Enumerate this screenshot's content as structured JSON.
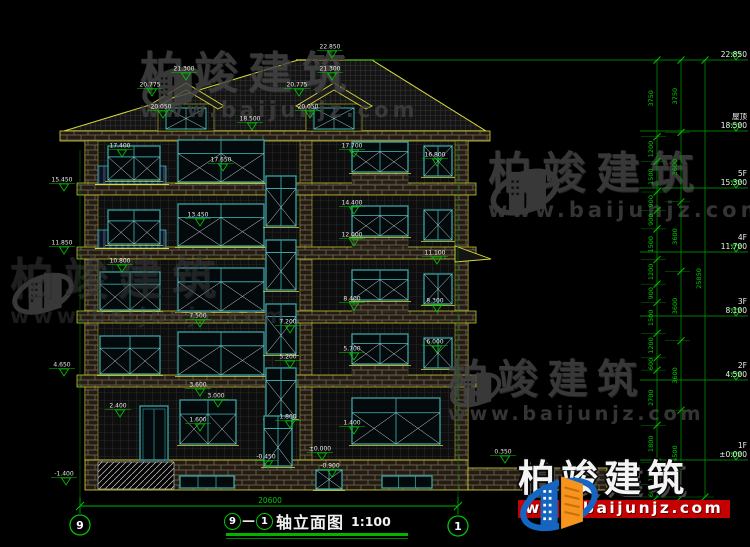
{
  "page": {
    "bg": "#000000"
  },
  "title_block": {
    "axis_start": "9",
    "dash": "—",
    "axis_end": "1",
    "name": "轴立面图",
    "scale": "1:100"
  },
  "bottom": {
    "total_dim": "20600",
    "axis_left": "9",
    "axis_right": "1"
  },
  "levels": [
    {
      "label": "",
      "value": "22.850",
      "y": 60
    },
    {
      "label": "屋顶",
      "value": "18.500",
      "y": 131
    },
    {
      "label": "5F",
      "value": "15.300",
      "y": 188
    },
    {
      "label": "4F",
      "value": "11.700",
      "y": 252
    },
    {
      "label": "3F",
      "value": "8.100",
      "y": 316
    },
    {
      "label": "2F",
      "value": "4.500",
      "y": 380
    },
    {
      "label": "1F",
      "value": "±0.000",
      "y": 460
    }
  ],
  "dim_chains": {
    "inner": [
      "3750",
      "1200",
      "1500",
      "900",
      "900",
      "1500",
      "1200",
      "900",
      "1500",
      "1200",
      "600",
      "2700",
      "1800",
      "1100",
      "600"
    ],
    "middle": [
      "3750",
      "3600",
      "3600",
      "3600",
      "3600",
      "4500"
    ],
    "total": [
      "25850"
    ]
  },
  "elevation_markers": [
    {
      "v": "22.850",
      "x": 332,
      "y": 58
    },
    {
      "v": "21.300",
      "x": 186,
      "y": 80
    },
    {
      "v": "20.775",
      "x": 152,
      "y": 96
    },
    {
      "v": "20.050",
      "x": 163,
      "y": 118
    },
    {
      "v": "21.300",
      "x": 332,
      "y": 80
    },
    {
      "v": "20.775",
      "x": 299,
      "y": 96
    },
    {
      "v": "20.050",
      "x": 310,
      "y": 118
    },
    {
      "v": "18.500",
      "x": 252,
      "y": 130
    },
    {
      "v": "17.400",
      "x": 122,
      "y": 157
    },
    {
      "v": "17.700",
      "x": 354,
      "y": 157
    },
    {
      "v": "17.650",
      "x": 223,
      "y": 171
    },
    {
      "v": "16.800",
      "x": 437,
      "y": 166
    },
    {
      "v": "15.450",
      "x": 64,
      "y": 191
    },
    {
      "v": "14.400",
      "x": 354,
      "y": 214
    },
    {
      "v": "13.450",
      "x": 200,
      "y": 226
    },
    {
      "v": "12.000",
      "x": 354,
      "y": 246
    },
    {
      "v": "11.850",
      "x": 64,
      "y": 254
    },
    {
      "v": "11.100",
      "x": 437,
      "y": 264
    },
    {
      "v": "10.800",
      "x": 122,
      "y": 272
    },
    {
      "v": "8.400",
      "x": 354,
      "y": 310
    },
    {
      "v": "8.300",
      "x": 437,
      "y": 312
    },
    {
      "v": "7.500",
      "x": 200,
      "y": 327
    },
    {
      "v": "7.200",
      "x": 290,
      "y": 333
    },
    {
      "v": "6.000",
      "x": 437,
      "y": 353
    },
    {
      "v": "5.700",
      "x": 354,
      "y": 360
    },
    {
      "v": "5.200",
      "x": 290,
      "y": 368
    },
    {
      "v": "4.650",
      "x": 64,
      "y": 376
    },
    {
      "v": "3.600",
      "x": 200,
      "y": 396
    },
    {
      "v": "3.000",
      "x": 218,
      "y": 407
    },
    {
      "v": "2.400",
      "x": 120,
      "y": 417
    },
    {
      "v": "1.800",
      "x": 290,
      "y": 428
    },
    {
      "v": "1.600",
      "x": 200,
      "y": 431
    },
    {
      "v": "1.400",
      "x": 354,
      "y": 434
    },
    {
      "v": "±0.000",
      "x": 322,
      "y": 460
    },
    {
      "v": "-0.450",
      "x": 268,
      "y": 468
    },
    {
      "v": "-0.900",
      "x": 332,
      "y": 477
    },
    {
      "v": "-1.400",
      "x": 66,
      "y": 485
    },
    {
      "v": "0.350",
      "x": 505,
      "y": 463
    }
  ],
  "watermark": {
    "brand": "柏竣建筑",
    "url": "www.baijunjz.com"
  },
  "colors": {
    "dim_green": "#00c800",
    "line_yellow": "#d8d838",
    "window_teal": "#3aa3a3",
    "brand_blue": "#1565c0",
    "brand_orange": "#f7941d",
    "url_red": "#c40000"
  }
}
